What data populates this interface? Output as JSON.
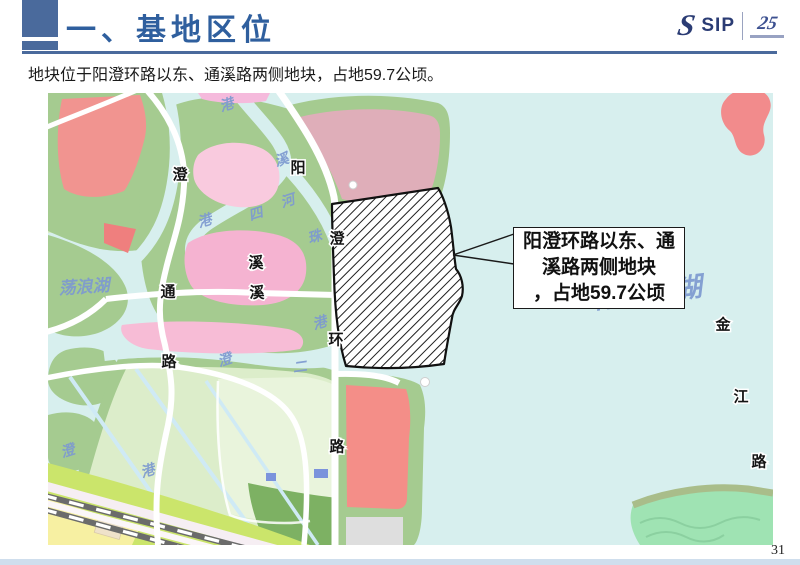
{
  "slide": {
    "title": "一、基地区位",
    "subtitle": "地块位于阳澄环路以东、通溪路两侧地块，占地59.7公顷。",
    "page_number": "31",
    "accent_color": "#4a6a9c",
    "title_color": "#2f5f9e"
  },
  "logo": {
    "s_glyph": "S",
    "name": "SIP",
    "anniversary": "25"
  },
  "map": {
    "colors": {
      "water": "#d7efee",
      "green_bank": "#a5cb90",
      "park_green": "#dcedca",
      "pink_block": "#f5b3d1",
      "dusty_pink_block": "#dfaeb9",
      "red_block": "#f2908c",
      "yellow_block": "#f7f0a2",
      "railway_gray": "#6b6b6b",
      "water_label_blue": "#7d9ad0",
      "site_hatch": "#111111"
    },
    "callout": {
      "line1": "阳澄环路以东、通",
      "line2": "溪路两侧地块",
      "line3": "，占地59.7公顷"
    },
    "road_labels": [
      {
        "t": "澄",
        "x": 132,
        "y": 82
      },
      {
        "t": "阳",
        "x": 250,
        "y": 75
      },
      {
        "t": "溪",
        "x": 208,
        "y": 170
      },
      {
        "t": "通",
        "x": 120,
        "y": 199
      },
      {
        "t": "溪",
        "x": 209,
        "y": 200
      },
      {
        "t": "路",
        "x": 121,
        "y": 269
      },
      {
        "t": "澄",
        "x": 289,
        "y": 146
      },
      {
        "t": "环",
        "x": 288,
        "y": 247
      },
      {
        "t": "路",
        "x": 289,
        "y": 354
      },
      {
        "t": "金",
        "x": 675,
        "y": 232
      },
      {
        "t": "江",
        "x": 693,
        "y": 304
      },
      {
        "t": "路",
        "x": 711,
        "y": 369
      }
    ],
    "water_labels": [
      {
        "t": "港",
        "x": 179,
        "y": 13,
        "r": -18
      },
      {
        "t": "溪",
        "x": 234,
        "y": 68,
        "r": -18
      },
      {
        "t": "河",
        "x": 240,
        "y": 109,
        "r": -18
      },
      {
        "t": "四",
        "x": 208,
        "y": 122,
        "r": -18
      },
      {
        "t": "港",
        "x": 157,
        "y": 129,
        "r": -18
      },
      {
        "t": "珠",
        "x": 267,
        "y": 145,
        "r": -18
      },
      {
        "t": "荡浪湖",
        "x": 36,
        "y": 194,
        "r": -4,
        "s": 17
      },
      {
        "t": "港",
        "x": 272,
        "y": 231,
        "r": -18
      },
      {
        "t": "澄",
        "x": 177,
        "y": 268,
        "r": -18
      },
      {
        "t": "二",
        "x": 252,
        "y": 275,
        "r": -8
      },
      {
        "t": "澄",
        "x": 20,
        "y": 359,
        "r": -18
      },
      {
        "t": "港",
        "x": 100,
        "y": 379,
        "r": -18
      },
      {
        "t": "阳澄东湖",
        "x": 600,
        "y": 200,
        "r": -7,
        "s": 27
      }
    ]
  }
}
